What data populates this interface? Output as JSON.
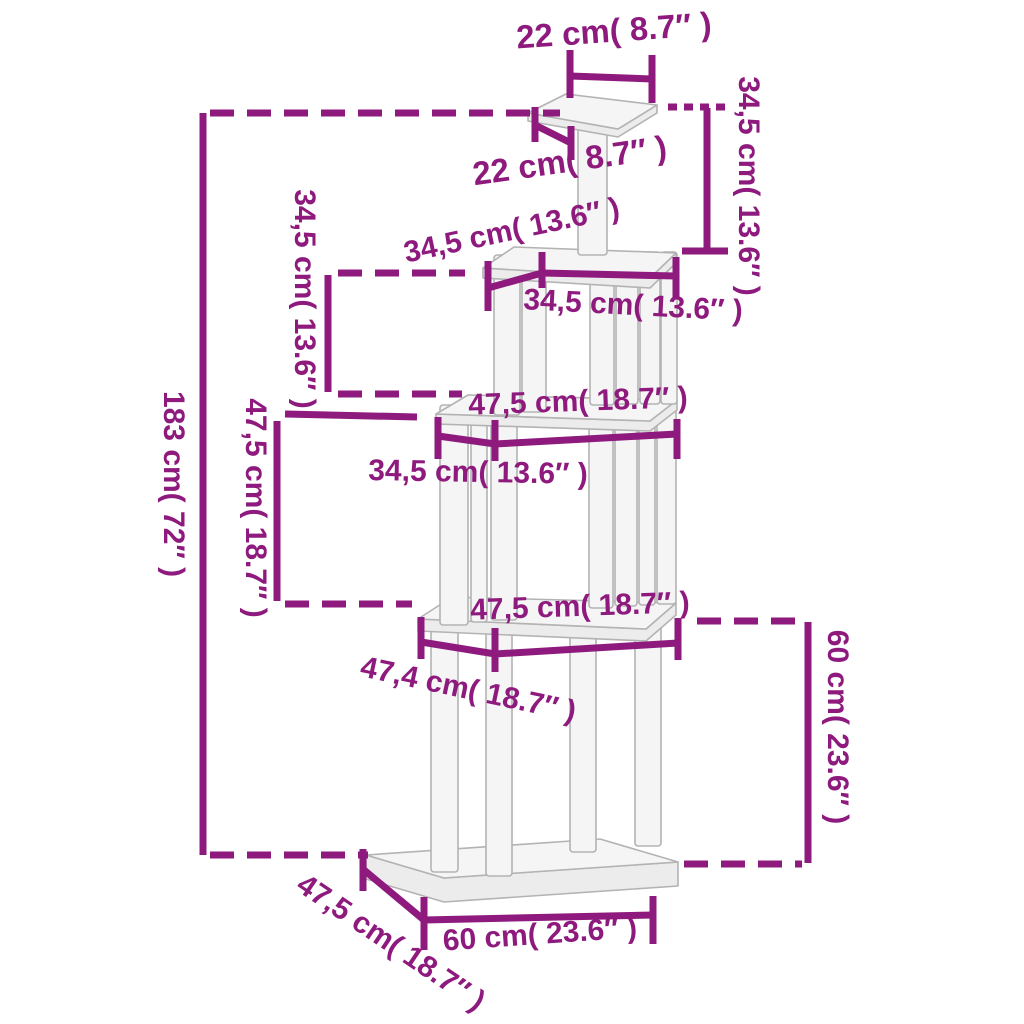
{
  "diagram": {
    "type": "product-dimension-diagram",
    "subject": "cat-tree-with-scratching-posts"
  },
  "labels": {
    "top_width": "22 cm( 8.7″ )",
    "top_depth": "22 cm( 8.7″ )",
    "upper_height_right": "34,5 cm( 13.6″ )",
    "upper_height_left": "34,5 cm( 13.6″ )",
    "p2_depth": "34,5 cm( 13.6″ )",
    "p2_width": "34,5 cm( 13.6″ )",
    "p3_width": "47,5 cm( 18.7″ )",
    "p3_span": "34,5 cm( 13.6″ )",
    "mid_height_left": "47,5 cm( 18.7″ )",
    "total_height": "183 cm( 72″ )",
    "p4_width": "47,5 cm( 18.7″ )",
    "p4_span": "47,4 cm( 18.7″ )",
    "lower_height_right": "60 cm( 23.6″ )",
    "base_width": "60 cm( 23.6″ )",
    "base_depth": "47,5 cm( 18.7″ )"
  },
  "colors": {
    "dimension": "#8e1a7e",
    "structure_fill": "#f5f5f5",
    "structure_side": "#ececec",
    "structure_stroke": "#b3b3b3",
    "background": "#ffffff"
  }
}
